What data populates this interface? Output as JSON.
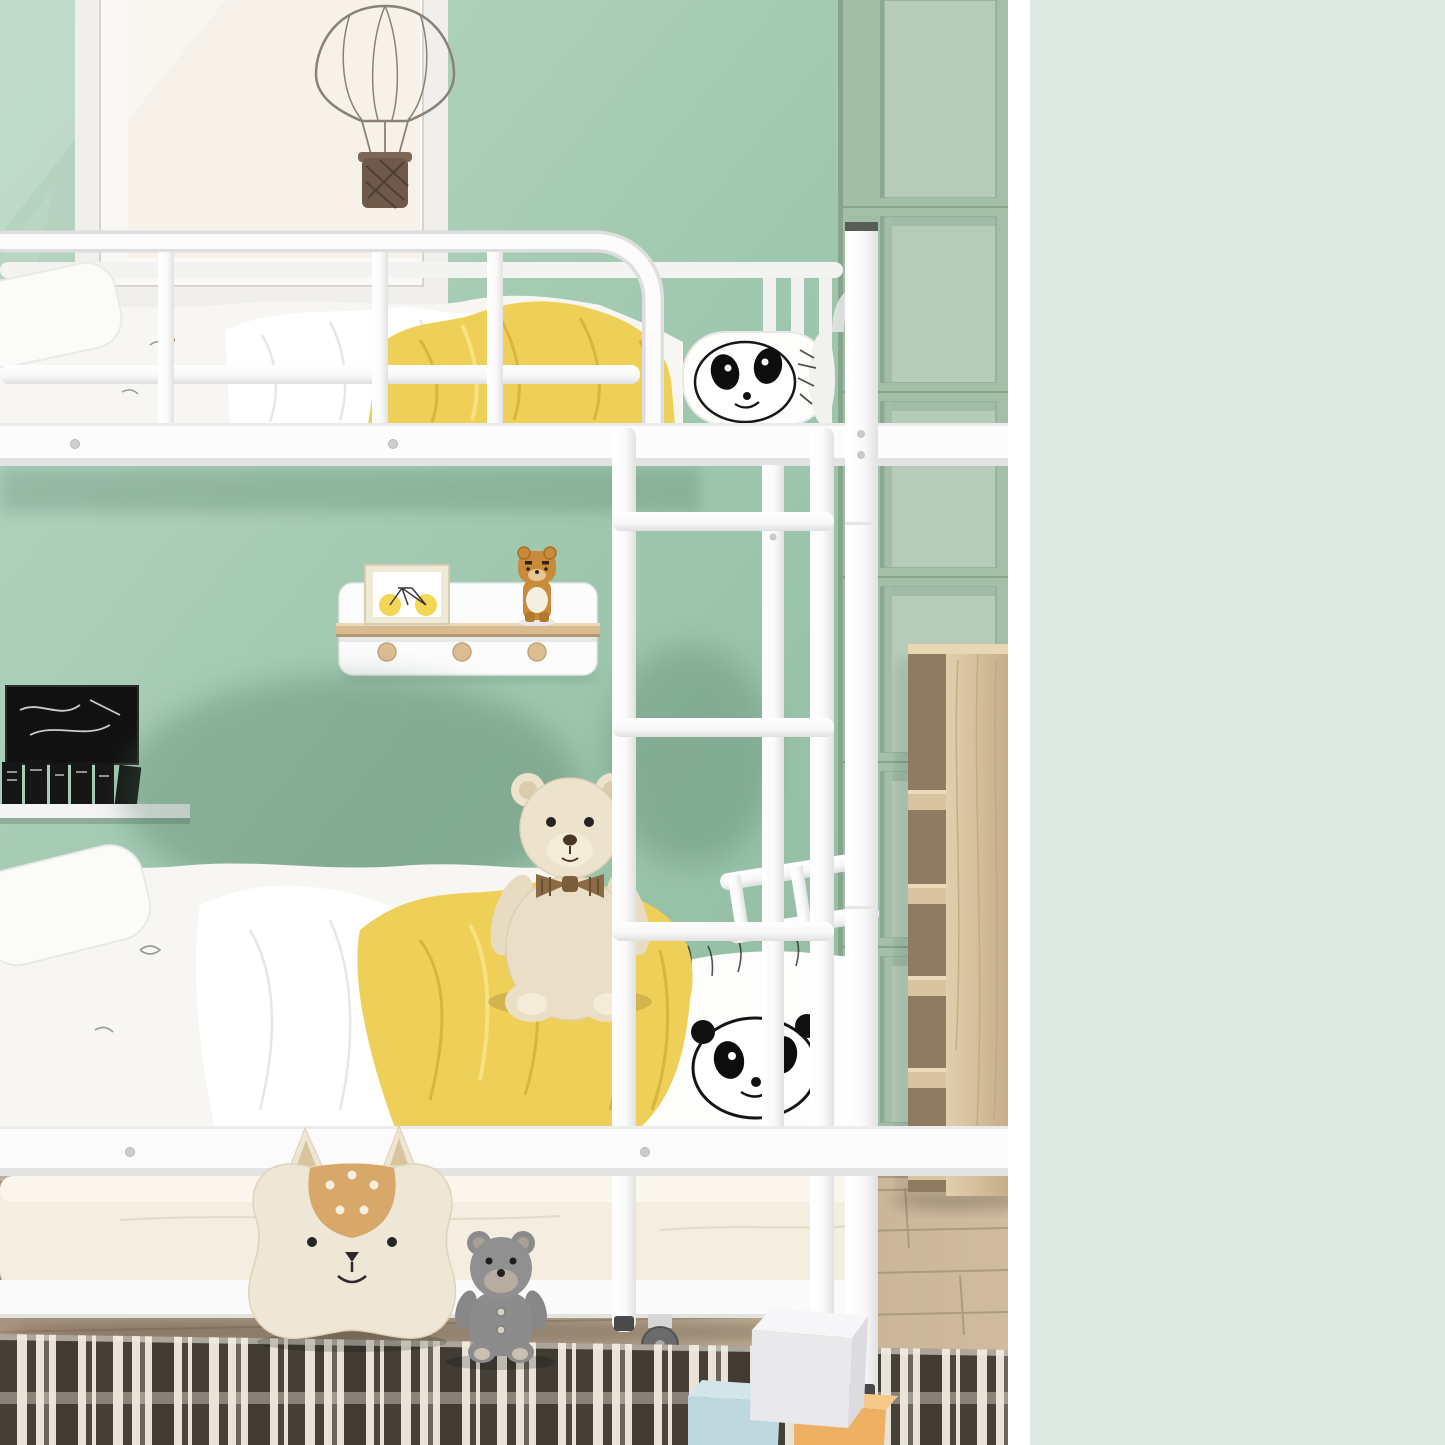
{
  "side_panel": {
    "background_color": "#dee9e3",
    "text_color": "#1e5a40",
    "circle_border_color": "#46715a",
    "features": [
      {
        "id": "ladder",
        "lines": [
          "Safe and Non-Slip Ladder"
        ]
      },
      {
        "id": "guardrails",
        "lines": [
          "Full Length",
          "Gridded Guardrails"
        ]
      },
      {
        "id": "slats",
        "lines": [
          "Sturdy Slats"
        ]
      }
    ]
  },
  "photo": {
    "palette": {
      "wall_green": "#9fc7ae",
      "panel_wall_green": "#aec6b2",
      "bed_frame_white": "#fbfbfb",
      "blanket_yellow": "#eecf57",
      "rug_dark": "#454138",
      "rug_cream": "#e8e3d6",
      "wood_light": "#d9c4a0",
      "floor_wood": "#bfa98e"
    }
  }
}
